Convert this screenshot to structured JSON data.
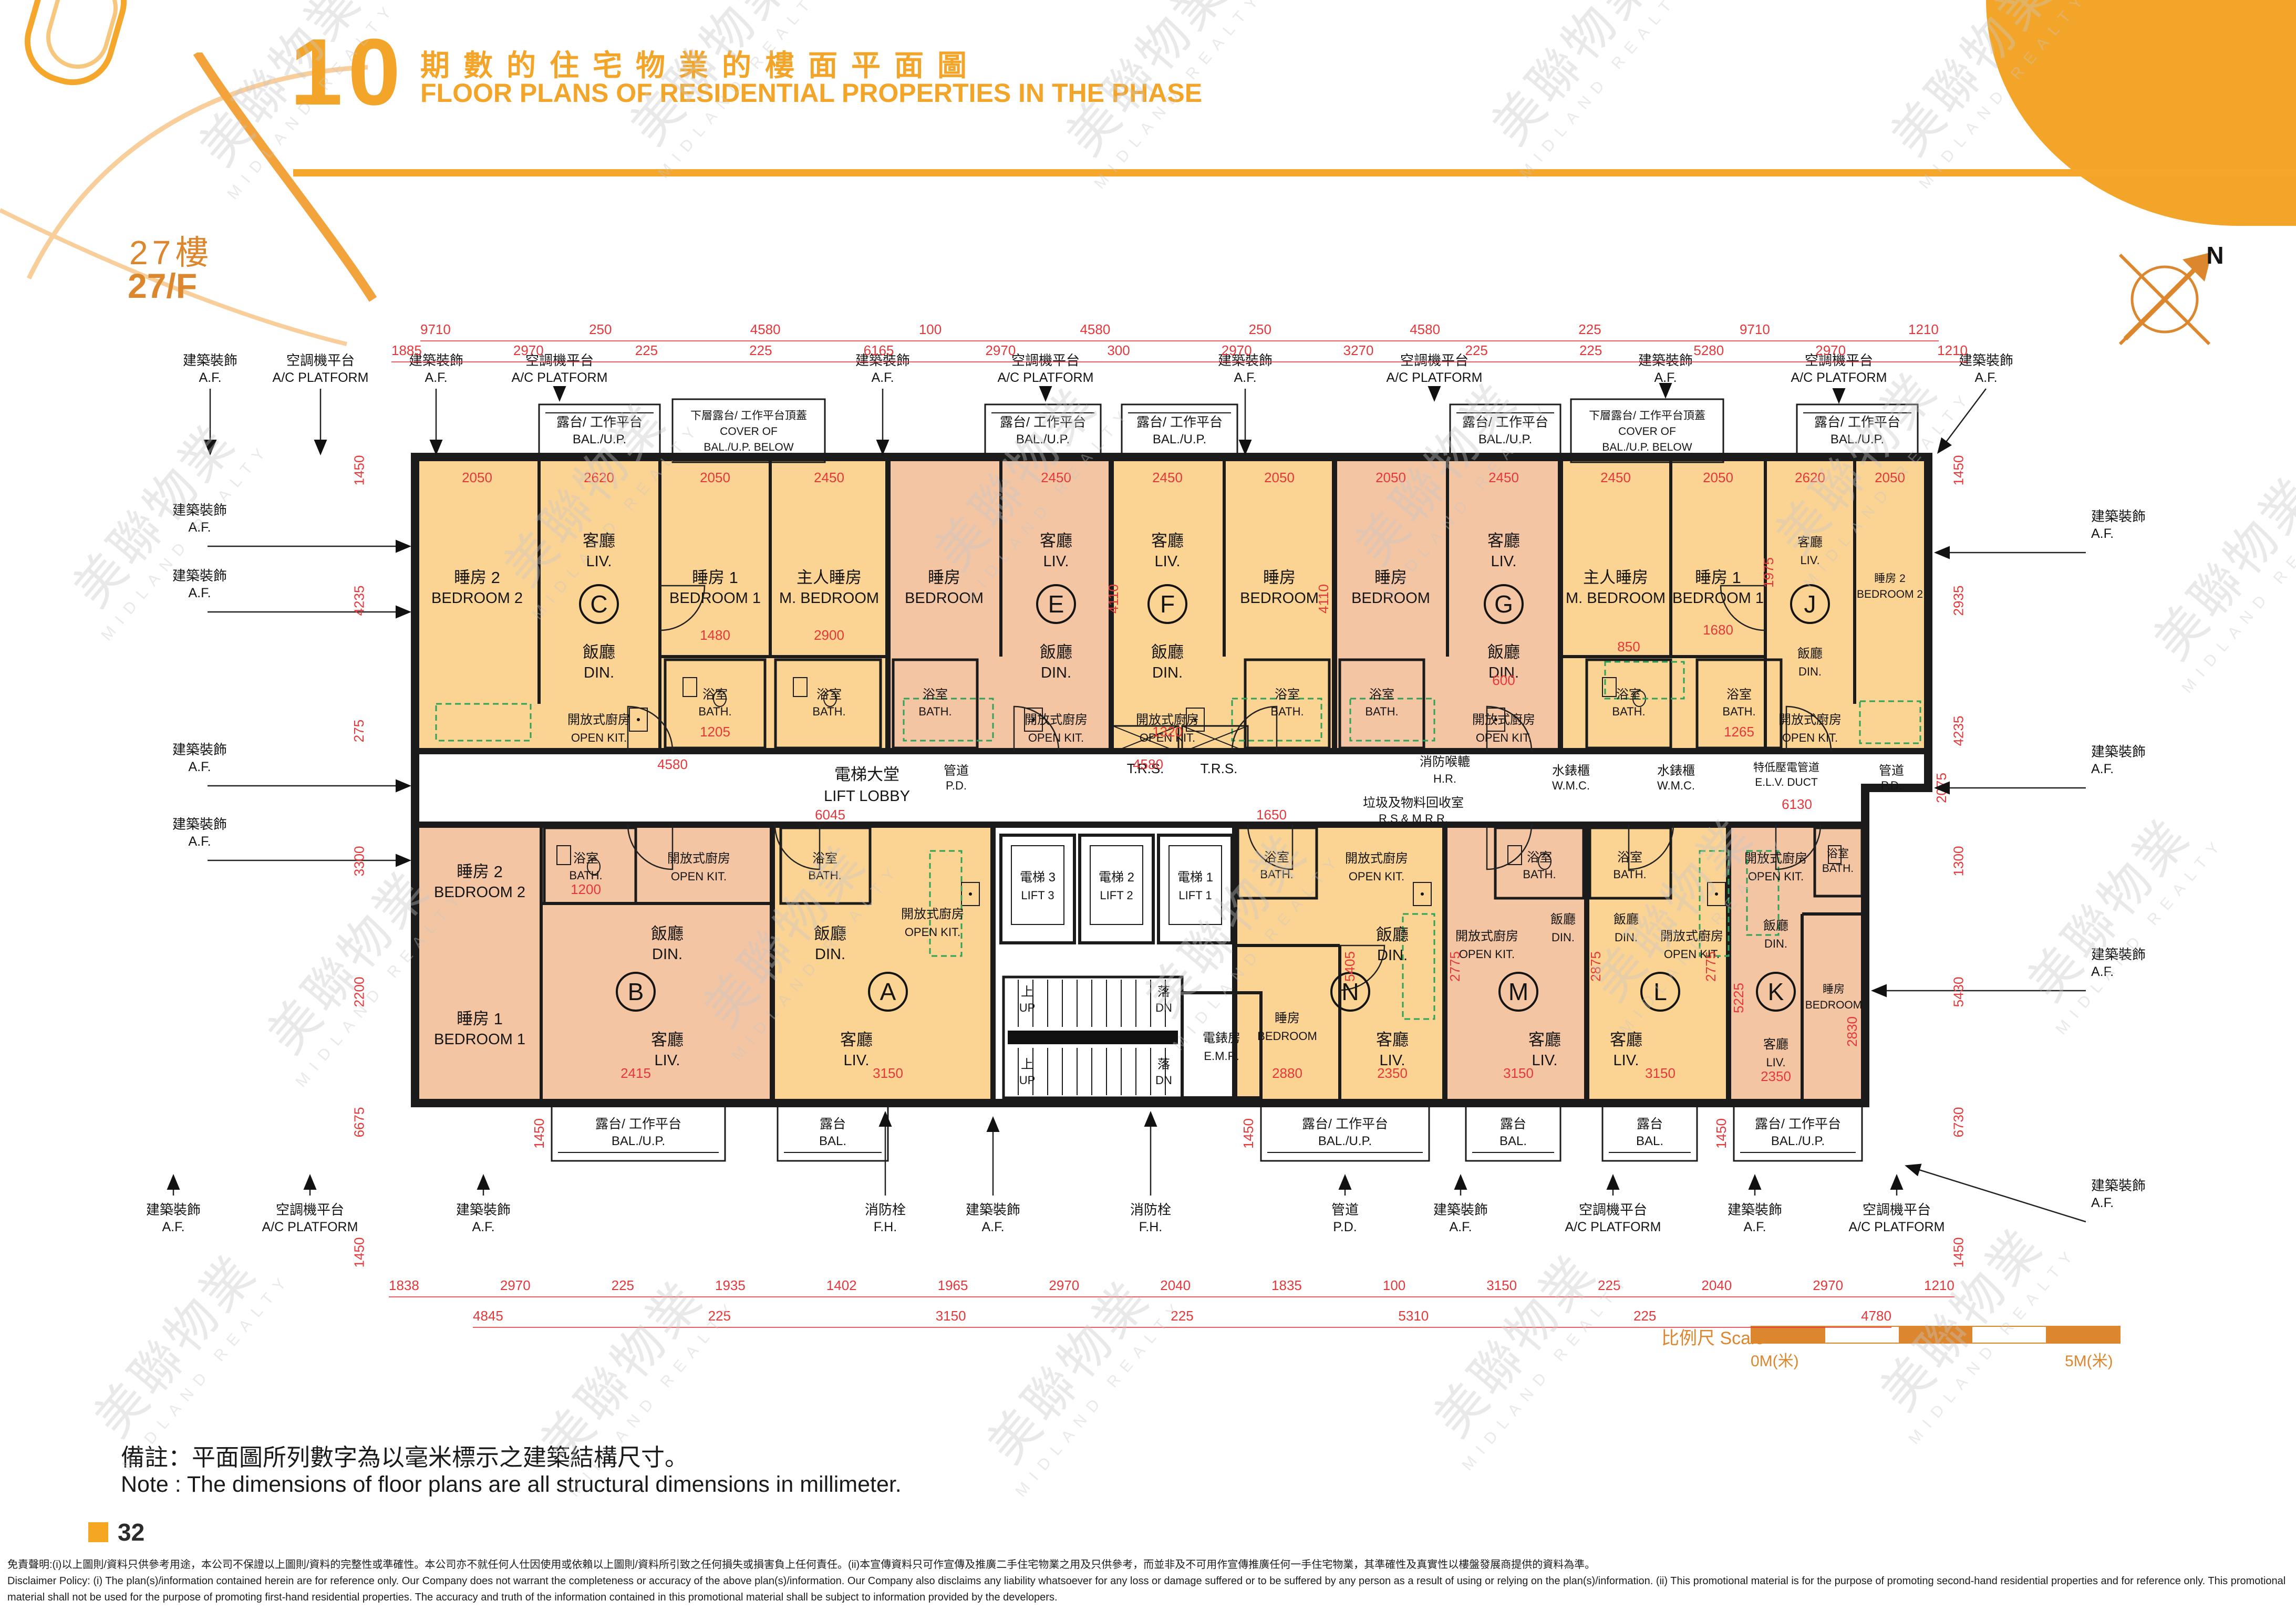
{
  "page": {
    "number": "32"
  },
  "header": {
    "section_no": "10",
    "title_zh": "期數的住宅物業的樓面平面圖",
    "title_en": "FLOOR PLANS OF RESIDENTIAL PROPERTIES IN THE PHASE"
  },
  "floor": {
    "zh": "27樓",
    "en": "27/F"
  },
  "compass": {
    "north": "N"
  },
  "watermark": {
    "zh": "美聯物業",
    "en": "MIDLAND REALTY"
  },
  "units": {
    "a": "A",
    "b": "B",
    "c": "C",
    "e": "E",
    "f": "F",
    "g": "G",
    "j": "J",
    "k": "K",
    "l": "L",
    "m": "M",
    "n": "N"
  },
  "rooms": {
    "liv": {
      "zh": "客廳",
      "en": "LIV."
    },
    "din": {
      "zh": "飯廳",
      "en": "DIN."
    },
    "open_kit": {
      "zh": "開放式廚房",
      "en": "OPEN KIT."
    },
    "bath": {
      "zh": "浴室",
      "en": "BATH."
    },
    "bedroom": {
      "zh": "睡房",
      "en": "BEDROOM"
    },
    "bedroom1": {
      "zh": "睡房 1",
      "en": "BEDROOM 1"
    },
    "bedroom2": {
      "zh": "睡房 2",
      "en": "BEDROOM 2"
    },
    "m_bedroom": {
      "zh": "主人睡房",
      "en": "M. BEDROOM"
    },
    "balup": {
      "zh": "露台/ 工作平台",
      "en": "BAL./U.P."
    },
    "bal": {
      "zh": "露台",
      "en": "BAL."
    }
  },
  "core": {
    "lift_lobby": {
      "zh": "電梯大堂",
      "en": "LIFT LOBBY"
    },
    "lift1": {
      "zh": "電梯 1",
      "en": "LIFT 1"
    },
    "lift2": {
      "zh": "電梯 2",
      "en": "LIFT 2"
    },
    "lift3": {
      "zh": "電梯 3",
      "en": "LIFT 3"
    },
    "emr": {
      "zh": "電錶房",
      "en": "E.M.R."
    },
    "up": {
      "zh": "上",
      "en": "UP"
    },
    "dn": {
      "zh": "落",
      "en": "DN"
    }
  },
  "callouts": {
    "af": {
      "zh": "建築裝飾",
      "en": "A.F."
    },
    "ac": {
      "zh": "空調機平台",
      "en": "A/C PLATFORM"
    },
    "fh": {
      "zh": "消防栓",
      "en": "F.H."
    },
    "pd": {
      "zh": "管道",
      "en": "P.D."
    },
    "wmc": {
      "zh": "水錶櫃",
      "en": "W.M.C."
    },
    "elv": {
      "zh": "特低壓電管道",
      "en": "E.L.V. DUCT"
    },
    "hr": {
      "zh": "消防喉轆",
      "en": "H.R."
    },
    "rs_mrr": {
      "zh": "垃圾及物料回收室",
      "en": "R.S.& M.R.R."
    },
    "trs": {
      "en": "T.R.S."
    },
    "cover": {
      "zh": "下層露台/ 工作平台頂蓋",
      "en1": "COVER OF",
      "en2": "BAL./U.P. BELOW"
    }
  },
  "dims": {
    "top1": [
      "9710",
      "250",
      "4580",
      "100",
      "4580",
      "250",
      "4580",
      "225",
      "9710",
      "1210"
    ],
    "top2": [
      "1885",
      "2970",
      "225",
      "225",
      "6165",
      "2970",
      "300",
      "2970",
      "3270",
      "225",
      "225",
      "5280",
      "2970",
      "1210"
    ],
    "left": [
      "1450",
      "4235",
      "275",
      "3300",
      "2200",
      "6675",
      "1450"
    ],
    "right": [
      "1450",
      "2935",
      "4235",
      "1300",
      "5430",
      "6730",
      "1450"
    ],
    "bottom1": [
      "1838",
      "2970",
      "225",
      "1935",
      "1402",
      "1965",
      "2970",
      "2040",
      "1835",
      "100",
      "3150",
      "225",
      "2040",
      "2970",
      "1210"
    ],
    "bottom2": [
      "4845",
      "225",
      "3150",
      "225",
      "5310",
      "225",
      "4780"
    ],
    "inner": [
      "2050",
      "2620",
      "2050",
      "2450",
      "2450",
      "2450",
      "2050",
      "2050",
      "2450",
      "2450",
      "2050",
      "2620",
      "2050",
      "4110",
      "4110",
      "1480",
      "2900",
      "4580",
      "4580",
      "6045",
      "6130",
      "2415",
      "3150",
      "2350",
      "3150",
      "3150",
      "2350",
      "2880",
      "5405",
      "2775",
      "2875",
      "2775",
      "5225",
      "1450",
      "1450",
      "1450",
      "1205",
      "1265",
      "1320",
      "1200",
      "2830",
      "2075",
      "1650",
      "850",
      "600",
      "1975",
      "1680"
    ]
  },
  "scalebar": {
    "label_zh": "比例尺",
    "label_en": "Scale",
    "from": "0M(米)",
    "to": "5M(米)"
  },
  "note": {
    "zh": "備註：平面圖所列數字為以毫米標示之建築結構尺寸。",
    "en": "Note : The dimensions of floor plans are all structural dimensions in millimeter."
  },
  "disclaimer": {
    "zh": "免責聲明:(i)以上圖則/資料只供參考用途，本公司不保證以上圖則/資料的完整性或準確性。本公司亦不就任何人仕因使用或依賴以上圖則/資料所引致之任何損失或損害負上任何責任。(ii)本宣傳資料只可作宣傳及推廣二手住宅物業之用及只供參考，而並非及不可用作宣傳推廣任何一手住宅物業，其準確性及真實性以樓盤發展商提供的資料為準。",
    "en": "Disclaimer Policy: (i) The plan(s)/information contained herein are for reference only. Our Company does not warrant the completeness or accuracy of the above plan(s)/information. Our Company also disclaims any liability whatsoever for any loss or damage suffered or to be suffered by any person as a result of using or relying on the plan(s)/information. (ii) This promotional material is for the purpose of promoting second-hand residential properties and for reference only. This promotional material shall not be used for the purpose of promoting first-hand residential properties. The accuracy and truth of the information contained in this promotional material shall be subject to information provided by the developers."
  }
}
